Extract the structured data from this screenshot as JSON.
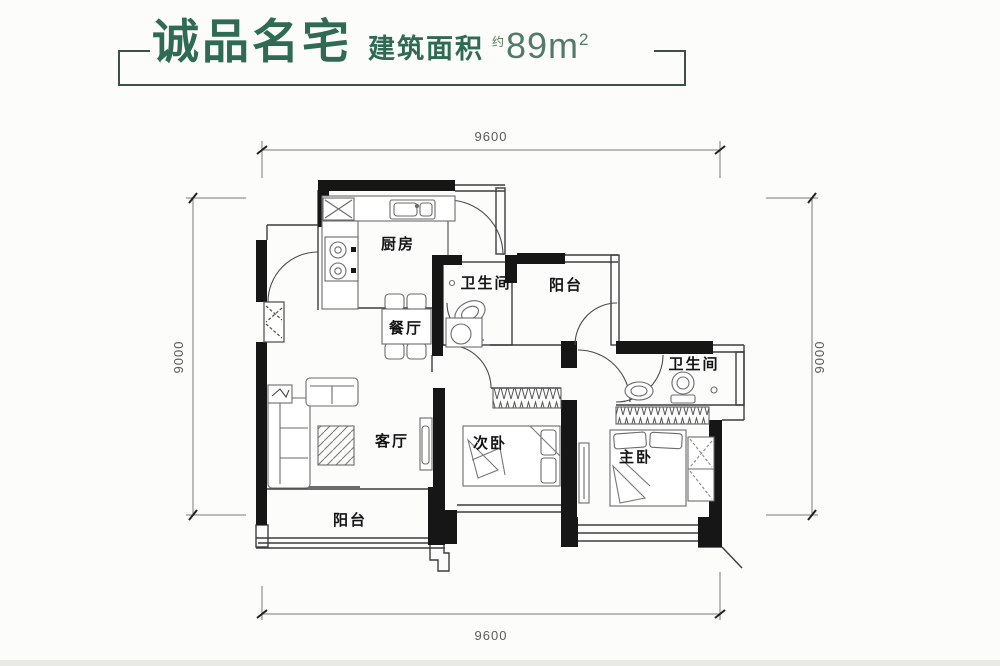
{
  "header": {
    "title": "诚品名宅",
    "area_label": "建筑面积",
    "approx": "约",
    "area_value": "89m",
    "area_sup": "2",
    "title_color": "#2e6b52",
    "value_color": "#527a68"
  },
  "floorplan": {
    "rooms": [
      {
        "id": "kitchen",
        "label": "厨房"
      },
      {
        "id": "bathroom-1",
        "label": "卫生间"
      },
      {
        "id": "balcony-top",
        "label": "阳台"
      },
      {
        "id": "dining",
        "label": "餐厅"
      },
      {
        "id": "bathroom-2",
        "label": "卫生间"
      },
      {
        "id": "living",
        "label": "客厅"
      },
      {
        "id": "bedroom-2",
        "label": "次卧"
      },
      {
        "id": "master-bedroom",
        "label": "主卧"
      },
      {
        "id": "balcony-bottom",
        "label": "阳台"
      }
    ],
    "dimensions": {
      "top": "9600",
      "bottom": "9600",
      "left": "9000",
      "right": "9000"
    }
  }
}
